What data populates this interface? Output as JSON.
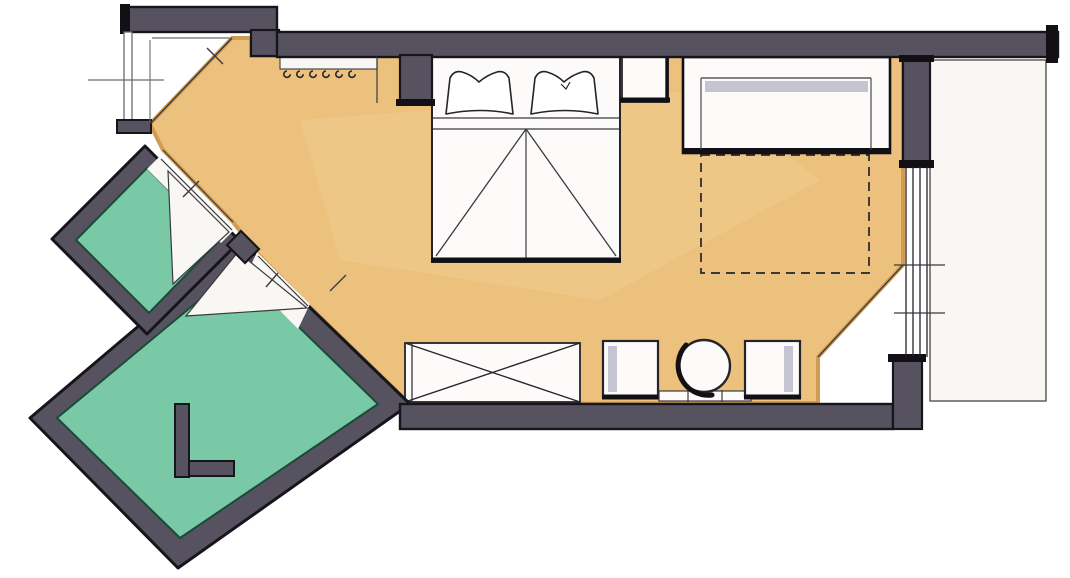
{
  "title": "hand-drawn hotel room floor plan sketch",
  "colors": {
    "paper": "#ffffff",
    "floor_main": "#ebc17d",
    "floor_main_edge": "#d09c53",
    "floor_bath": "#79c8a6",
    "floor_bath_edge": "#1b4a39",
    "wall": "#575260",
    "wall_outline": "#17151c",
    "floor_white": "#f8f7f3",
    "line_thin": "#3a3a3e",
    "line_soft": "#6b6b70",
    "furniture_fill": "#fcfbf9",
    "furniture_outline": "#26242a",
    "upholstery_gray": "#c5c5d1"
  },
  "rooms": [
    {
      "name": "main-room",
      "floor": "sand"
    },
    {
      "name": "bathroom-upper",
      "floor": "teal"
    },
    {
      "name": "bathroom-lower",
      "floor": "teal"
    },
    {
      "name": "entry-vestibule",
      "floor": "white"
    },
    {
      "name": "balcony",
      "floor": "white"
    }
  ],
  "furniture": [
    "double-bed-with-two-pillows",
    "nightstand",
    "sofa-with-pullout-footprint",
    "coat-hook-rail",
    "wardrobe-closet-x",
    "armchair-left",
    "round-table-with-chair",
    "bench-radiator",
    "armchair-right"
  ],
  "architecture": [
    "exterior-walls",
    "entry-door-swing",
    "bathroom-door-swings",
    "window-glazing-four-lines",
    "wall-pillars"
  ]
}
